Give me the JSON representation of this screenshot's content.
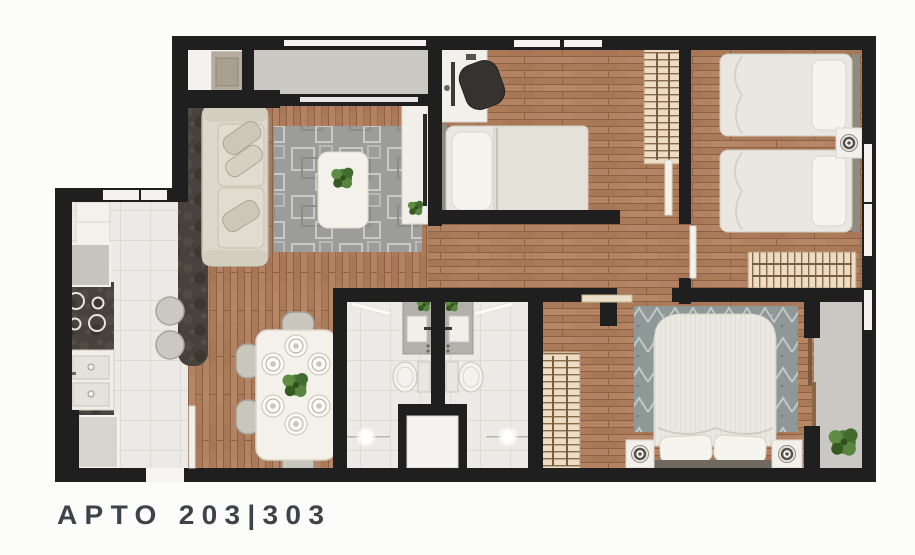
{
  "footer": {
    "label": "APTO 203|303"
  },
  "palette": {
    "wall": "#1f1f1f",
    "wood_floor": "#ae7e5e",
    "tile_floor": "#eceae6",
    "balcony_floor": "#cbc8c3",
    "dark_stone_counter": "#47423d",
    "living_rug": "#9c9c9a",
    "master_rug": "#8d9897",
    "furniture_white": "#f2f0ea",
    "fabric_beige": "#dcd9cc",
    "wardrobe_wood": "#eeddc5",
    "plant_green": "#4d7a37",
    "label_text": "#3d434a",
    "background": "#fcfcfb"
  }
}
